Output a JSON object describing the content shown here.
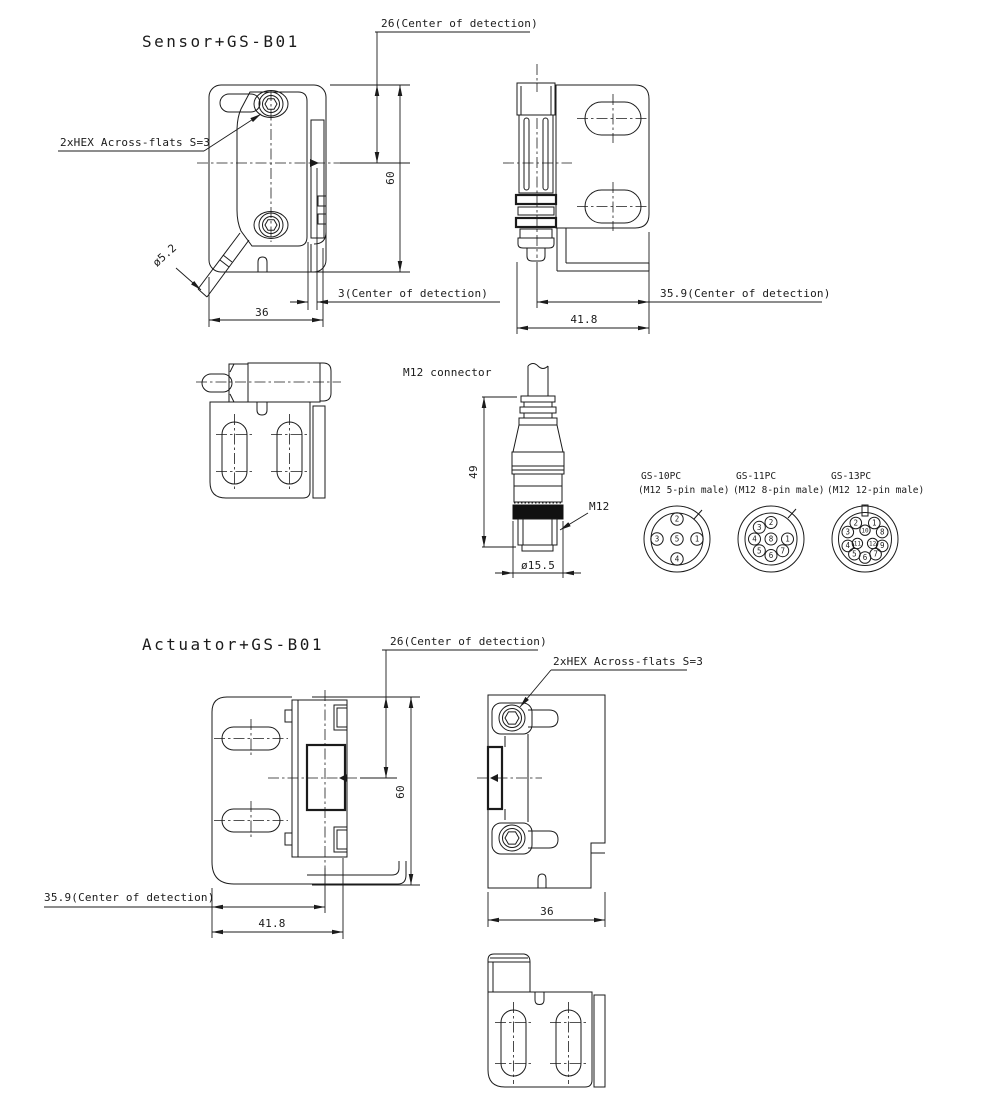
{
  "drawing": {
    "background": "#ffffff",
    "line_color": "#1b1b1b",
    "sensor": {
      "title": "Sensor+GS-B01",
      "labels": {
        "center_detection_26": "26(Center of detection)",
        "hex": "2xHEX Across-flats S=3",
        "cable_diameter": "ø5.2",
        "height_60": "60",
        "center_detection_3": "3(Center of detection)",
        "width_36": "36",
        "center_detection_359": "35.9(Center of detection)",
        "width_418": "41.8"
      }
    },
    "connector": {
      "title": "M12 connector",
      "length_49": "49",
      "thread": "M12",
      "diameter": "ø15.5"
    },
    "pinouts": [
      {
        "name": "GS-10PC",
        "type": "(M12 5-pin male)",
        "pins": [
          "1",
          "2",
          "3",
          "4",
          "5"
        ]
      },
      {
        "name": "GS-11PC",
        "type": "(M12 8-pin male)",
        "pins": [
          "1",
          "2",
          "3",
          "4",
          "5",
          "6",
          "7",
          "8"
        ]
      },
      {
        "name": "GS-13PC",
        "type": "(M12 12-pin male)",
        "pins": [
          "1",
          "2",
          "3",
          "4",
          "5",
          "6",
          "7",
          "8",
          "9",
          "10",
          "11",
          "12"
        ]
      }
    ],
    "actuator": {
      "title": "Actuator+GS-B01",
      "labels": {
        "center_detection_26": "26(Center of detection)",
        "hex": "2xHEX Across-flats S=3",
        "height_60": "60",
        "center_detection_359": "35.9(Center of detection)",
        "width_418": "41.8",
        "width_36": "36"
      }
    }
  }
}
